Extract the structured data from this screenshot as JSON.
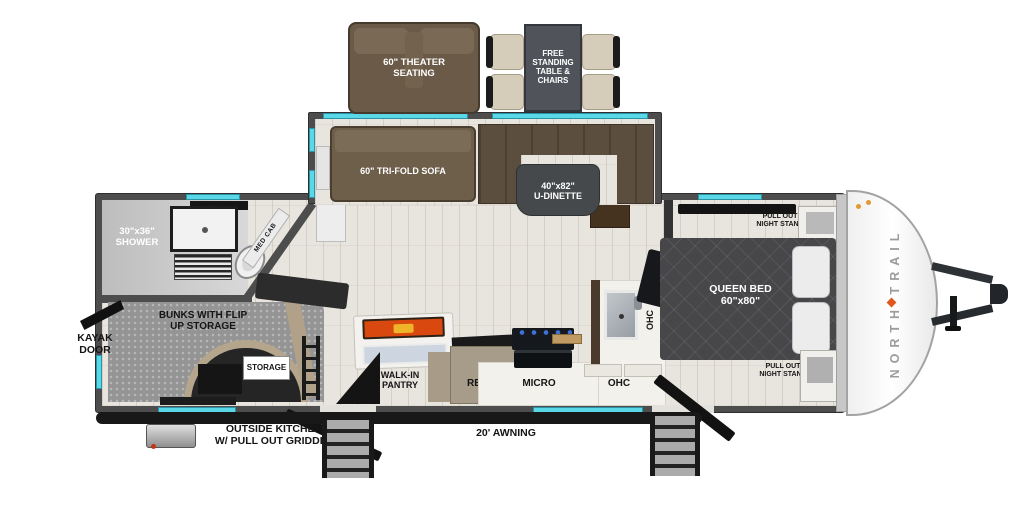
{
  "brand": {
    "name": "NORTH TRAIL"
  },
  "exterior_top": {
    "theater_l1": "60\" THEATER",
    "theater_l2": "SEATING",
    "table_l1": "FREE",
    "table_l2": "STANDING",
    "table_l3": "TABLE &",
    "table_l4": "CHAIRS"
  },
  "slideout": {
    "sofa": "60\" TRI-FOLD SOFA",
    "dinette_l1": "40\"x82\"",
    "dinette_l2": "U-DINETTE"
  },
  "bathroom": {
    "shower_l1": "30\"x36\"",
    "shower_l2": "SHOWER",
    "med_cab": "MED CAB"
  },
  "bunkroom": {
    "bunks_l1": "BUNKS WITH FLIP",
    "bunks_l2": "UP STORAGE",
    "storage": "STORAGE"
  },
  "kitchen": {
    "pantry_l1": "WALK-IN",
    "pantry_l2": "PANTRY",
    "refer": "REFER",
    "micro": "MICRO",
    "ohc_bottom": "OHC",
    "ohc_side": "OHC"
  },
  "bedroom": {
    "bed_l1": "QUEEN BED",
    "bed_l2": "60\"x80\"",
    "ns_top_l1": "PULL OUT",
    "ns_top_l2": "NIGHT STAND",
    "ns_bottom_l1": "PULL OUT",
    "ns_bottom_l2": "NIGHT STAND"
  },
  "exterior_left": {
    "kayak_l1": "KAYAK",
    "kayak_l2": "DOOR"
  },
  "exterior_bottom": {
    "outside_kitchen_l1": "OUTSIDE KITCHEN",
    "outside_kitchen_l2": "W/ PULL OUT GRIDDLE",
    "awning": "20' AWNING"
  },
  "colors": {
    "window": "#5ad8e7",
    "wall": "#4d4d4d",
    "accent": "#e0581e"
  }
}
